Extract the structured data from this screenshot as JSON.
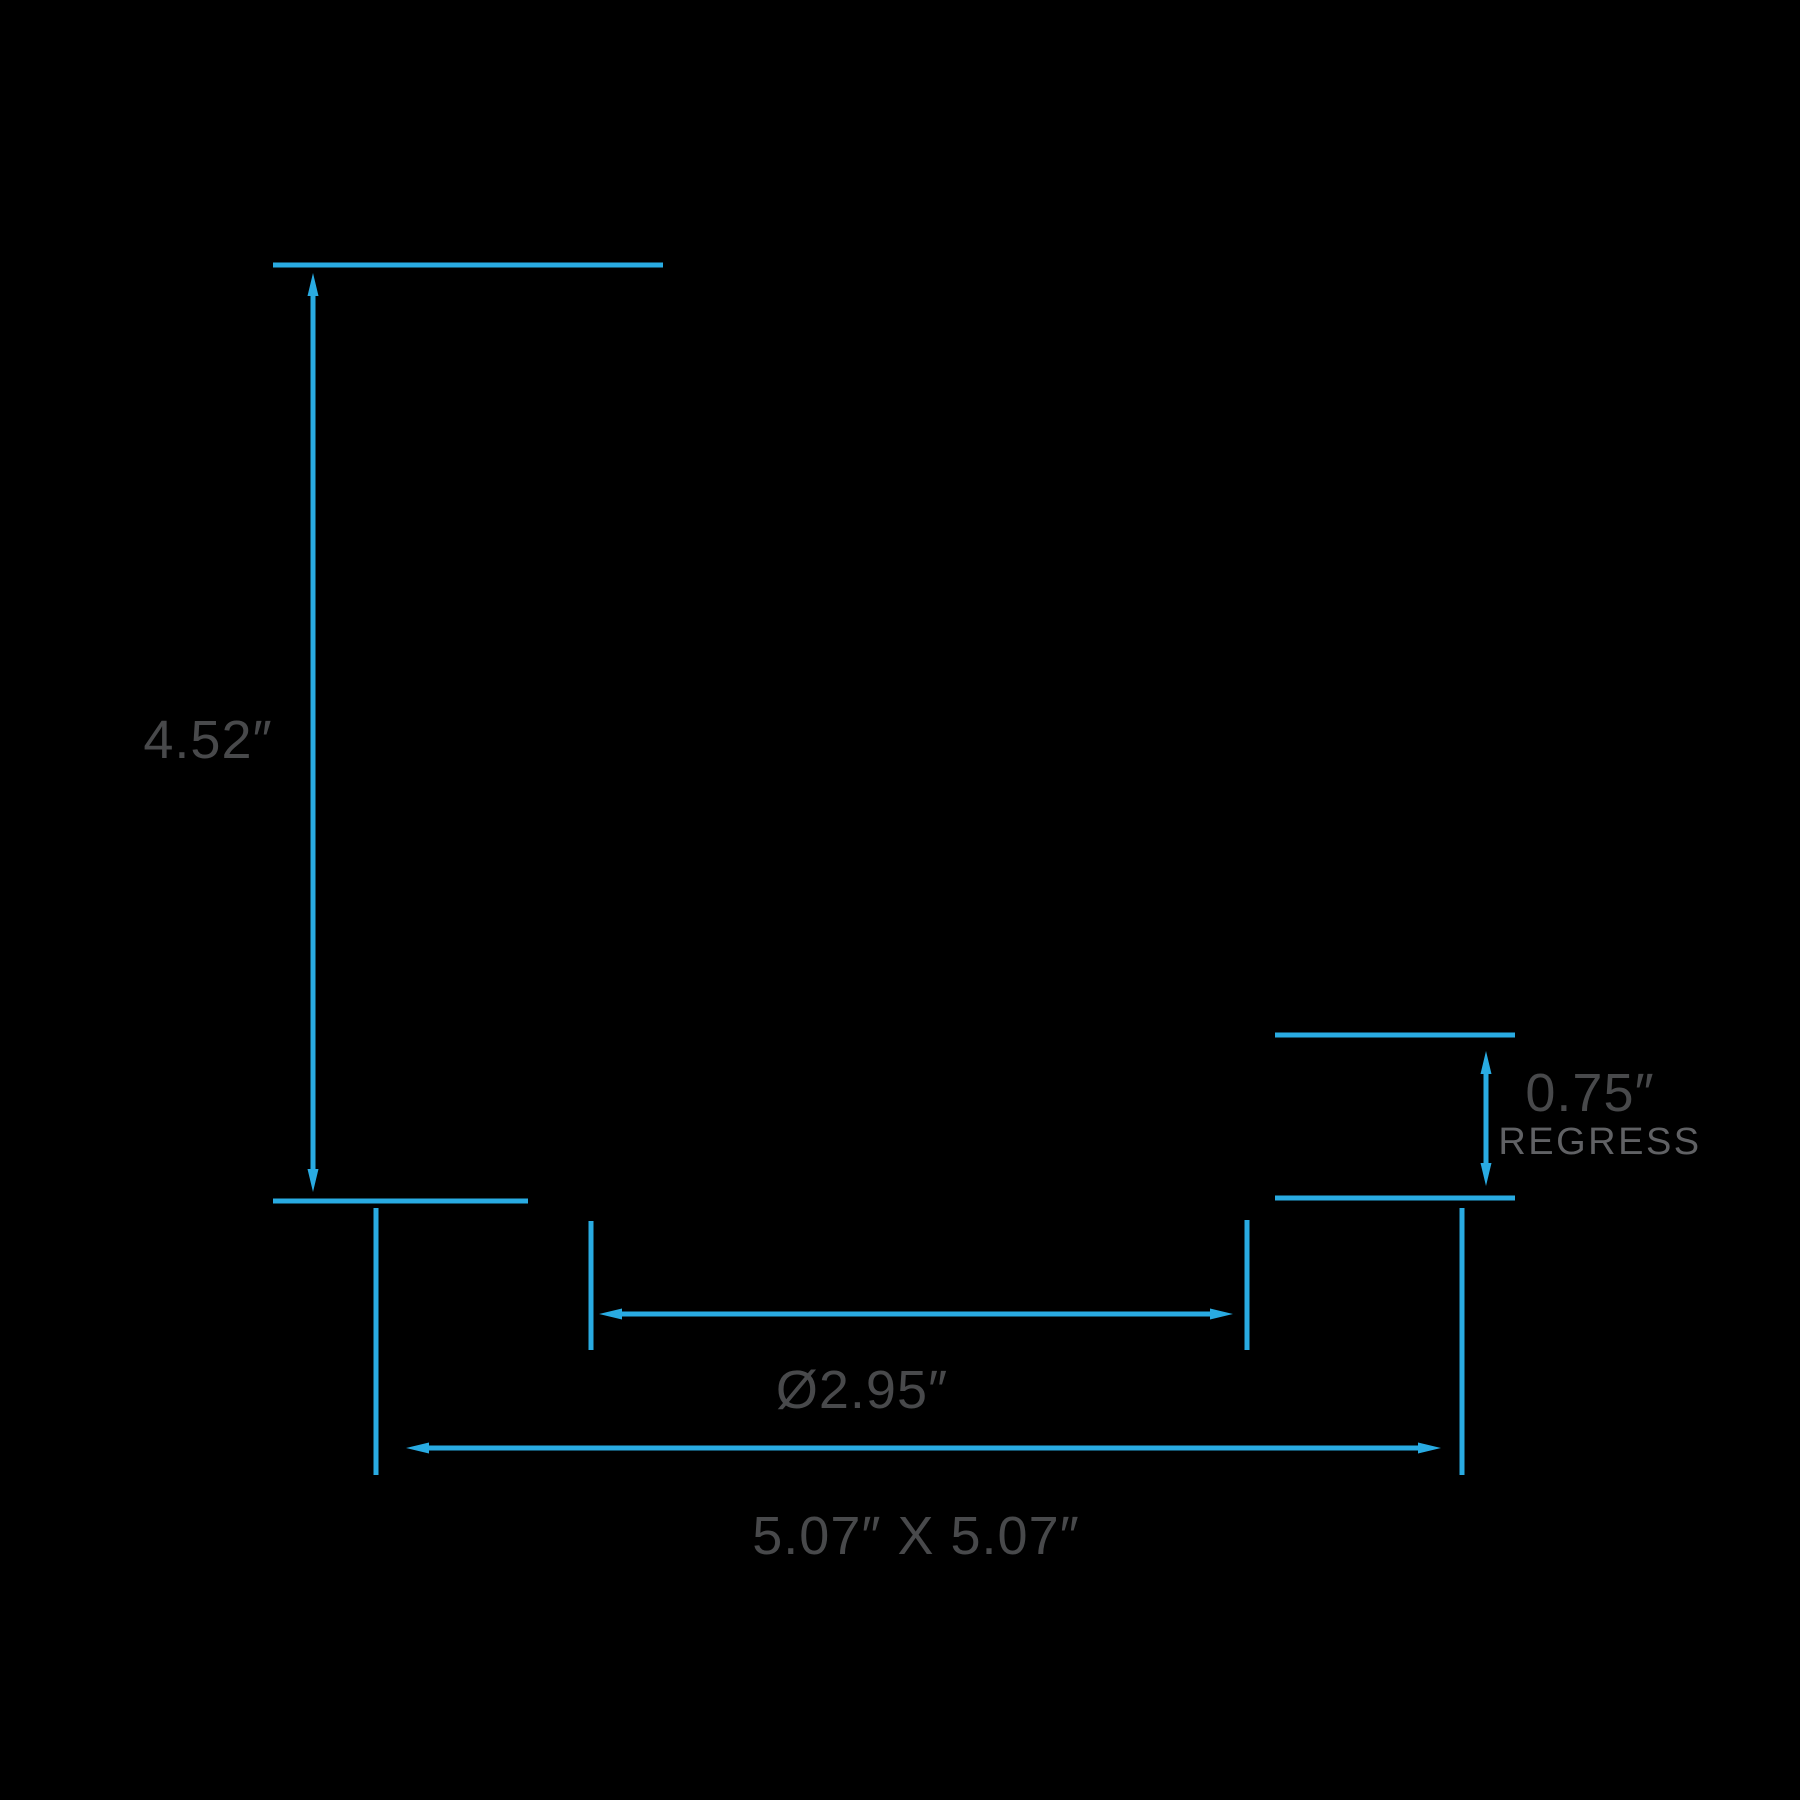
{
  "colors": {
    "accent": "#29abe2",
    "label_text": "#48494b",
    "caption_text": "#606164",
    "background": "#000000"
  },
  "labels": {
    "height": "4.52″",
    "regress_value": "0.75″",
    "regress_caption": "REGRESS",
    "aperture_diameter": "Ø2.95″",
    "cutout": "5.07″ X 5.07″"
  }
}
